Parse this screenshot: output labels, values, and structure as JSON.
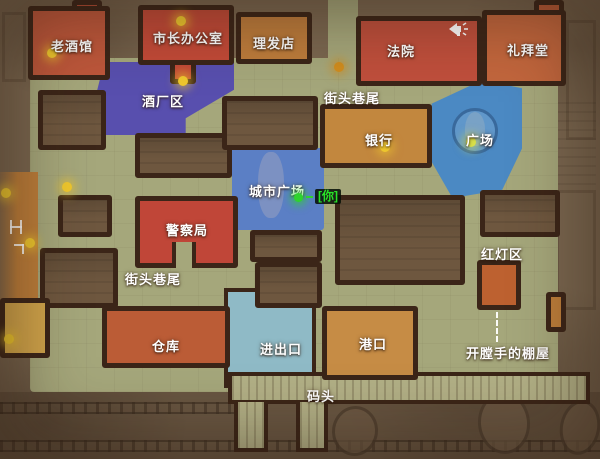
{
  "zones": {
    "tavern": {
      "label": "老酒馆",
      "color": "#bd573b"
    },
    "mayor_office": {
      "label": "市长办公室",
      "color": "#c24a38"
    },
    "barber_shop": {
      "label": "理发店",
      "color": "#bd7c3c"
    },
    "courthouse": {
      "label": "法院",
      "color": "#bf4f3c"
    },
    "chapel": {
      "label": "礼拜堂",
      "color": "#c2663d"
    },
    "brewery_district": {
      "label": "酒厂区",
      "color": "#584fae"
    },
    "street_corner_north": {
      "label": "街头巷尾"
    },
    "bank": {
      "label": "银行",
      "color": "#c2873e"
    },
    "plaza": {
      "label": "广场",
      "color": "#4b89c3"
    },
    "city_square": {
      "label": "城市广场",
      "color": "#5b7fc5"
    },
    "police_station": {
      "label": "警察局",
      "color": "#c04638"
    },
    "red_light_district": {
      "label": "红灯区",
      "color": "#bd6130"
    },
    "street_corner_west": {
      "label": "街头巷尾"
    },
    "warehouse": {
      "label": "仓库",
      "color": "#bb5c36"
    },
    "entrance_exit": {
      "label": "进出口",
      "color": "#8fbac6"
    },
    "port": {
      "label": "港口",
      "color": "#c68c45"
    },
    "rippers_shack": {
      "label": "开膛手的棚屋"
    },
    "dock": {
      "label": "码头",
      "color": "#b2b086"
    }
  },
  "player": {
    "label": "[你]",
    "color": "#28e228"
  },
  "icons": {
    "announcement": "megaphone-icon"
  },
  "map_colors": {
    "background": "#7a6750",
    "street": "#a5a77b",
    "outline": "#3b2518",
    "lamp": "#eec72e",
    "water": "#6a5643"
  }
}
